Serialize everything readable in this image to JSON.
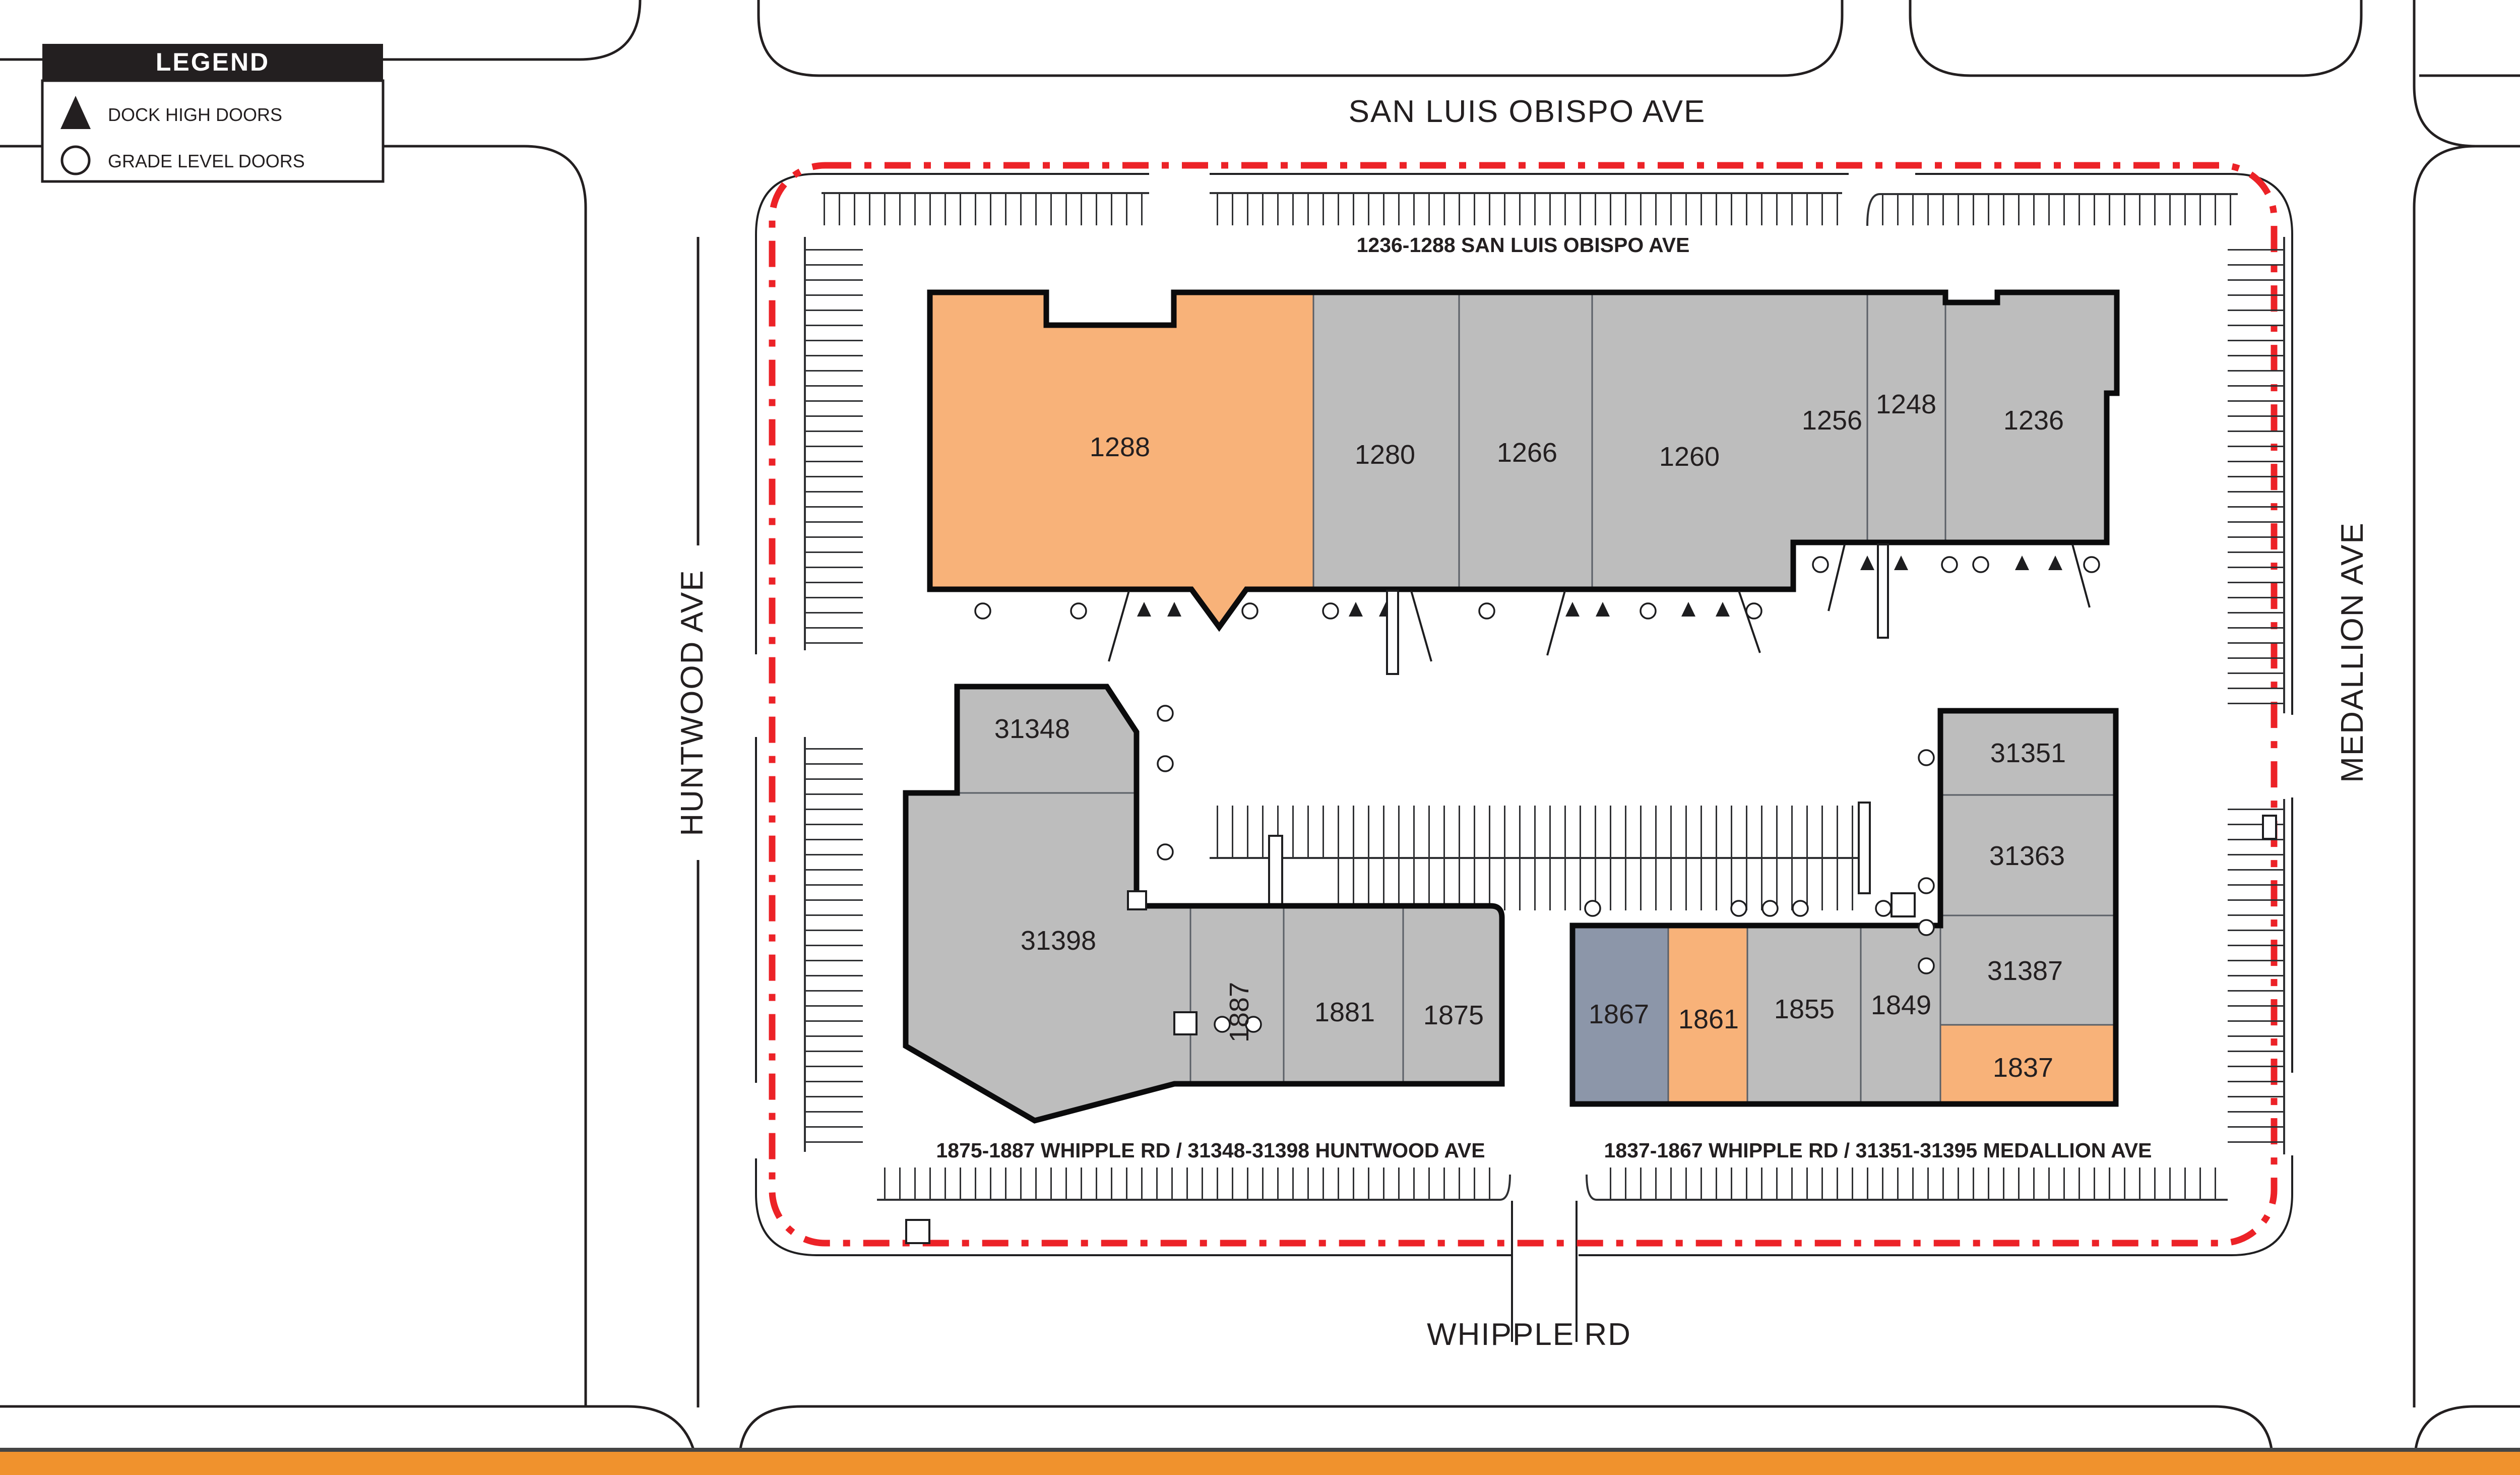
{
  "legend": {
    "title": "LEGEND",
    "items": [
      {
        "symbol": "dock-high-triangle-icon",
        "label": "DOCK HIGH DOORS"
      },
      {
        "symbol": "grade-level-circle-icon",
        "label": "GRADE LEVEL DOORS"
      }
    ]
  },
  "compass": {
    "label": "N"
  },
  "streets": {
    "top": "SAN LUIS OBISPO AVE",
    "bottom": "WHIPPLE RD",
    "left": "HUNTWOOD AVE",
    "right": "MEDALLION AVE"
  },
  "buildings": [
    {
      "id": "north-building",
      "address_label": "1236-1288 SAN LUIS OBISPO AVE",
      "units": [
        {
          "number": "1288",
          "highlight": "orange"
        },
        {
          "number": "1280",
          "highlight": "gray"
        },
        {
          "number": "1266",
          "highlight": "gray"
        },
        {
          "number": "1260",
          "highlight": "gray"
        },
        {
          "number": "1256",
          "highlight": "gray"
        },
        {
          "number": "1248",
          "highlight": "gray"
        },
        {
          "number": "1236",
          "highlight": "gray"
        }
      ]
    },
    {
      "id": "southwest-building",
      "address_label": "1875-1887 WHIPPLE RD / 31348-31398 HUNTWOOD AVE",
      "units": [
        {
          "number": "31348",
          "highlight": "gray"
        },
        {
          "number": "31398",
          "highlight": "gray"
        },
        {
          "number": "1887",
          "highlight": "gray"
        },
        {
          "number": "1881",
          "highlight": "gray"
        },
        {
          "number": "1875",
          "highlight": "gray"
        }
      ]
    },
    {
      "id": "southeast-building",
      "address_label": "1837-1867 WHIPPLE RD / 31351-31395 MEDALLION AVE",
      "units": [
        {
          "number": "1867",
          "highlight": "blue"
        },
        {
          "number": "1861",
          "highlight": "orange"
        },
        {
          "number": "1855",
          "highlight": "gray"
        },
        {
          "number": "1849",
          "highlight": "gray"
        },
        {
          "number": "31351",
          "highlight": "gray"
        },
        {
          "number": "31363",
          "highlight": "gray"
        },
        {
          "number": "31387",
          "highlight": "gray"
        },
        {
          "number": "1837",
          "highlight": "orange"
        }
      ]
    }
  ],
  "colors": {
    "unit_gray": "#BDBDBD",
    "unit_orange": "#F8B279",
    "unit_blue": "#8C96A9",
    "boundary_red": "#EC2227",
    "footer_orange": "#F0922D",
    "line_black": "#231F20"
  }
}
